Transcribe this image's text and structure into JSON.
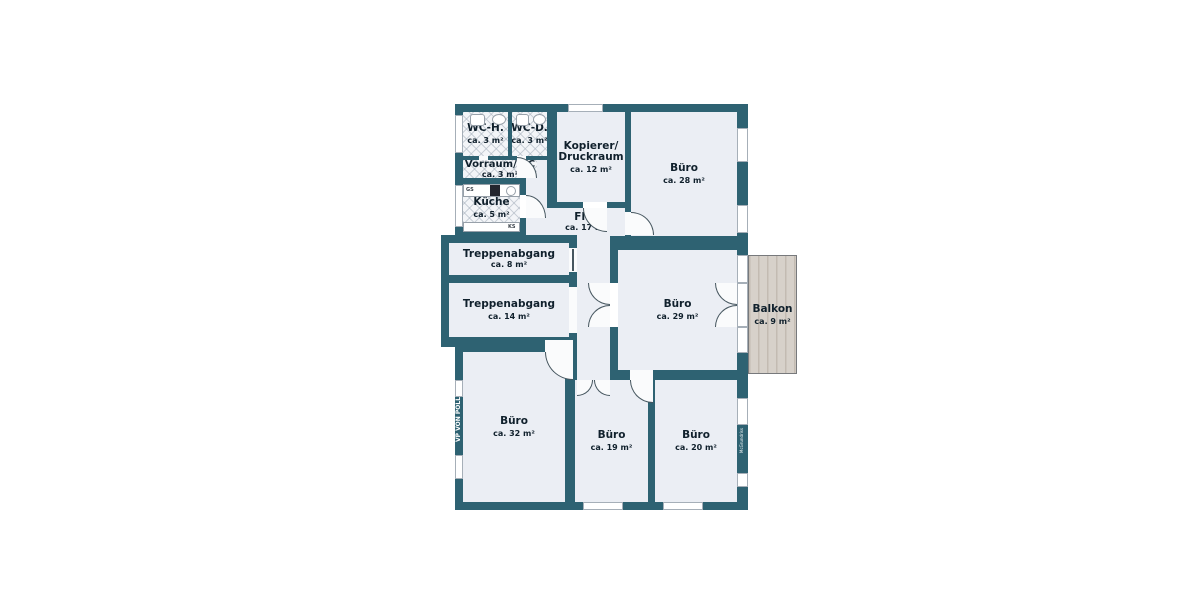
{
  "plan_type": "floor-plan",
  "colors": {
    "wall": "#2e6272",
    "room_fill": "#ebeef4",
    "wet_room_fill": "#f3f5f8",
    "balcony_fill": "#d7d1ca",
    "background": "#ffffff"
  },
  "rooms": {
    "wc_h": {
      "label": "WC-H.",
      "area": "ca. 3 m²"
    },
    "wc_d": {
      "label": "WC-D.",
      "area": "ca. 3 m²"
    },
    "vorraum_wc": {
      "label": "Vorraum/WC",
      "area": "ca. 3 m²"
    },
    "kueche": {
      "label": "Küche",
      "area": "ca. 5 m²"
    },
    "kopierer": {
      "label_line1": "Kopierer/",
      "label_line2": "Druckraum",
      "area": "ca. 12 m²"
    },
    "buero_28": {
      "label": "Büro",
      "area": "ca. 28 m²"
    },
    "flur": {
      "label": "Flur",
      "area": "ca. 17 m²"
    },
    "treppenabgang_8": {
      "label": "Treppenabgang",
      "area": "ca. 8 m²"
    },
    "treppenabgang_14": {
      "label": "Treppenabgang",
      "area": "ca. 14 m²"
    },
    "buero_29": {
      "label": "Büro",
      "area": "ca. 29 m²"
    },
    "balkon": {
      "label": "Balkon",
      "area": "ca. 9 m²"
    },
    "buero_32": {
      "label": "Büro",
      "area": "ca. 32 m²"
    },
    "buero_19": {
      "label": "Büro",
      "area": "ca. 19 m²"
    },
    "buero_20": {
      "label": "Büro",
      "area": "ca. 20 m²"
    }
  },
  "fixtures": {
    "dishwasher_label": "GS",
    "fridge_label": "KS"
  },
  "watermarks": {
    "brand_left": "VP VON POLL",
    "brand_right": "McGrundriss"
  }
}
